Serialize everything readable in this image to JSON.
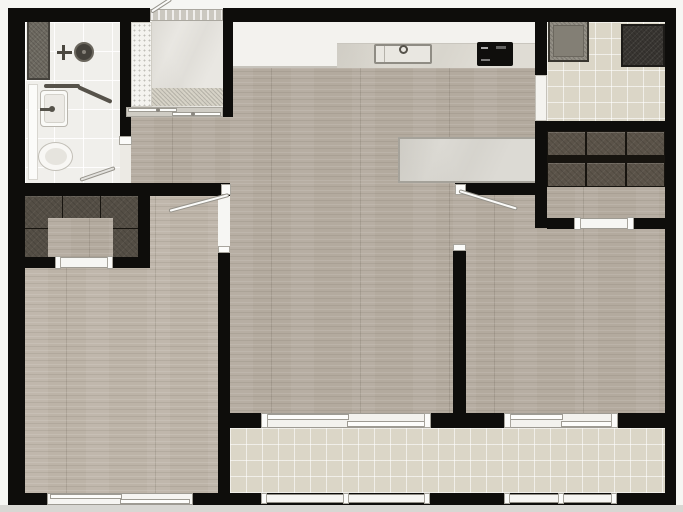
{
  "meta": {
    "title": "apartment-floor-plan",
    "view": "2d-top-down-floor-plan",
    "canvas": {
      "width": 683,
      "height": 512
    },
    "visible_text": []
  },
  "palette": {
    "wall": "#0e0d0b",
    "wood_floor": "#b3aa9e",
    "balcony_tile": "#dbd6c7",
    "bathroom_tile": "#f0efeb",
    "foyer_marble": "#e9e7e2",
    "counter_white": "#f3f2ee",
    "counter_marble": "#dfdcd4",
    "dining_table_marble": "#dcdad4",
    "wardrobe_dark": "#5b5349",
    "appliance_gray": "#908c82",
    "appliance_dark": "#383531",
    "cooktop_black": "#0f0e0c",
    "frame_white": "#fdfdfb",
    "outside_margin": "#f6f6f3"
  },
  "rooms": [
    {
      "id": "bathroom",
      "label": "bathroom",
      "floor": "white tile",
      "fixtures": [
        "storage-ledge",
        "shower-head",
        "mixer-valve",
        "glass-partition",
        "washbasin",
        "toilet",
        "hinged-door"
      ]
    },
    {
      "id": "entry-foyer",
      "label": "entry foyer",
      "floor": "marble tile",
      "fixtures": [
        "entry-door",
        "threshold",
        "shoe-cabinet",
        "marble-mat",
        "pocket-slider"
      ]
    },
    {
      "id": "kitchen",
      "label": "kitchen counter",
      "floor": "wood",
      "fixtures": [
        "counter-run",
        "double-sink",
        "faucet",
        "induction-cooktop"
      ]
    },
    {
      "id": "laundry-room",
      "label": "service / laundry room",
      "floor": "beige tile",
      "fixtures": [
        "washing-machine",
        "dark-appliance",
        "wall-opening"
      ]
    },
    {
      "id": "wardrobe-room",
      "label": "wardrobe room",
      "floor": "wood",
      "fixtures": [
        "upper-cabinet-row-3-units",
        "lower-cabinet-row-3-units",
        "sliding-opening"
      ]
    },
    {
      "id": "living-dining",
      "label": "living / dining area",
      "floor": "wood",
      "fixtures": [
        "dining-table",
        "balcony-sliding-door"
      ]
    },
    {
      "id": "walk-in-closet",
      "label": "walk-in closet",
      "floor": "wood niche",
      "fixtures": [
        "u-shaped-wardrobe",
        "sliding-opening"
      ]
    },
    {
      "id": "bedroom-left",
      "label": "left bedroom",
      "floor": "wood",
      "fixtures": [
        "hinged-door",
        "bottom-window"
      ]
    },
    {
      "id": "bedroom-right",
      "label": "right bedroom",
      "floor": "wood",
      "fixtures": [
        "hinged-door",
        "balcony-sliding-door"
      ]
    },
    {
      "id": "balcony",
      "label": "balcony",
      "floor": "beige tile",
      "fixtures": [
        "railing-left-segment",
        "railing-right-segment"
      ]
    }
  ],
  "openings": {
    "hinged_doors": 4,
    "sliding_doors": 5,
    "windows": 1,
    "railing_segments": 2
  }
}
